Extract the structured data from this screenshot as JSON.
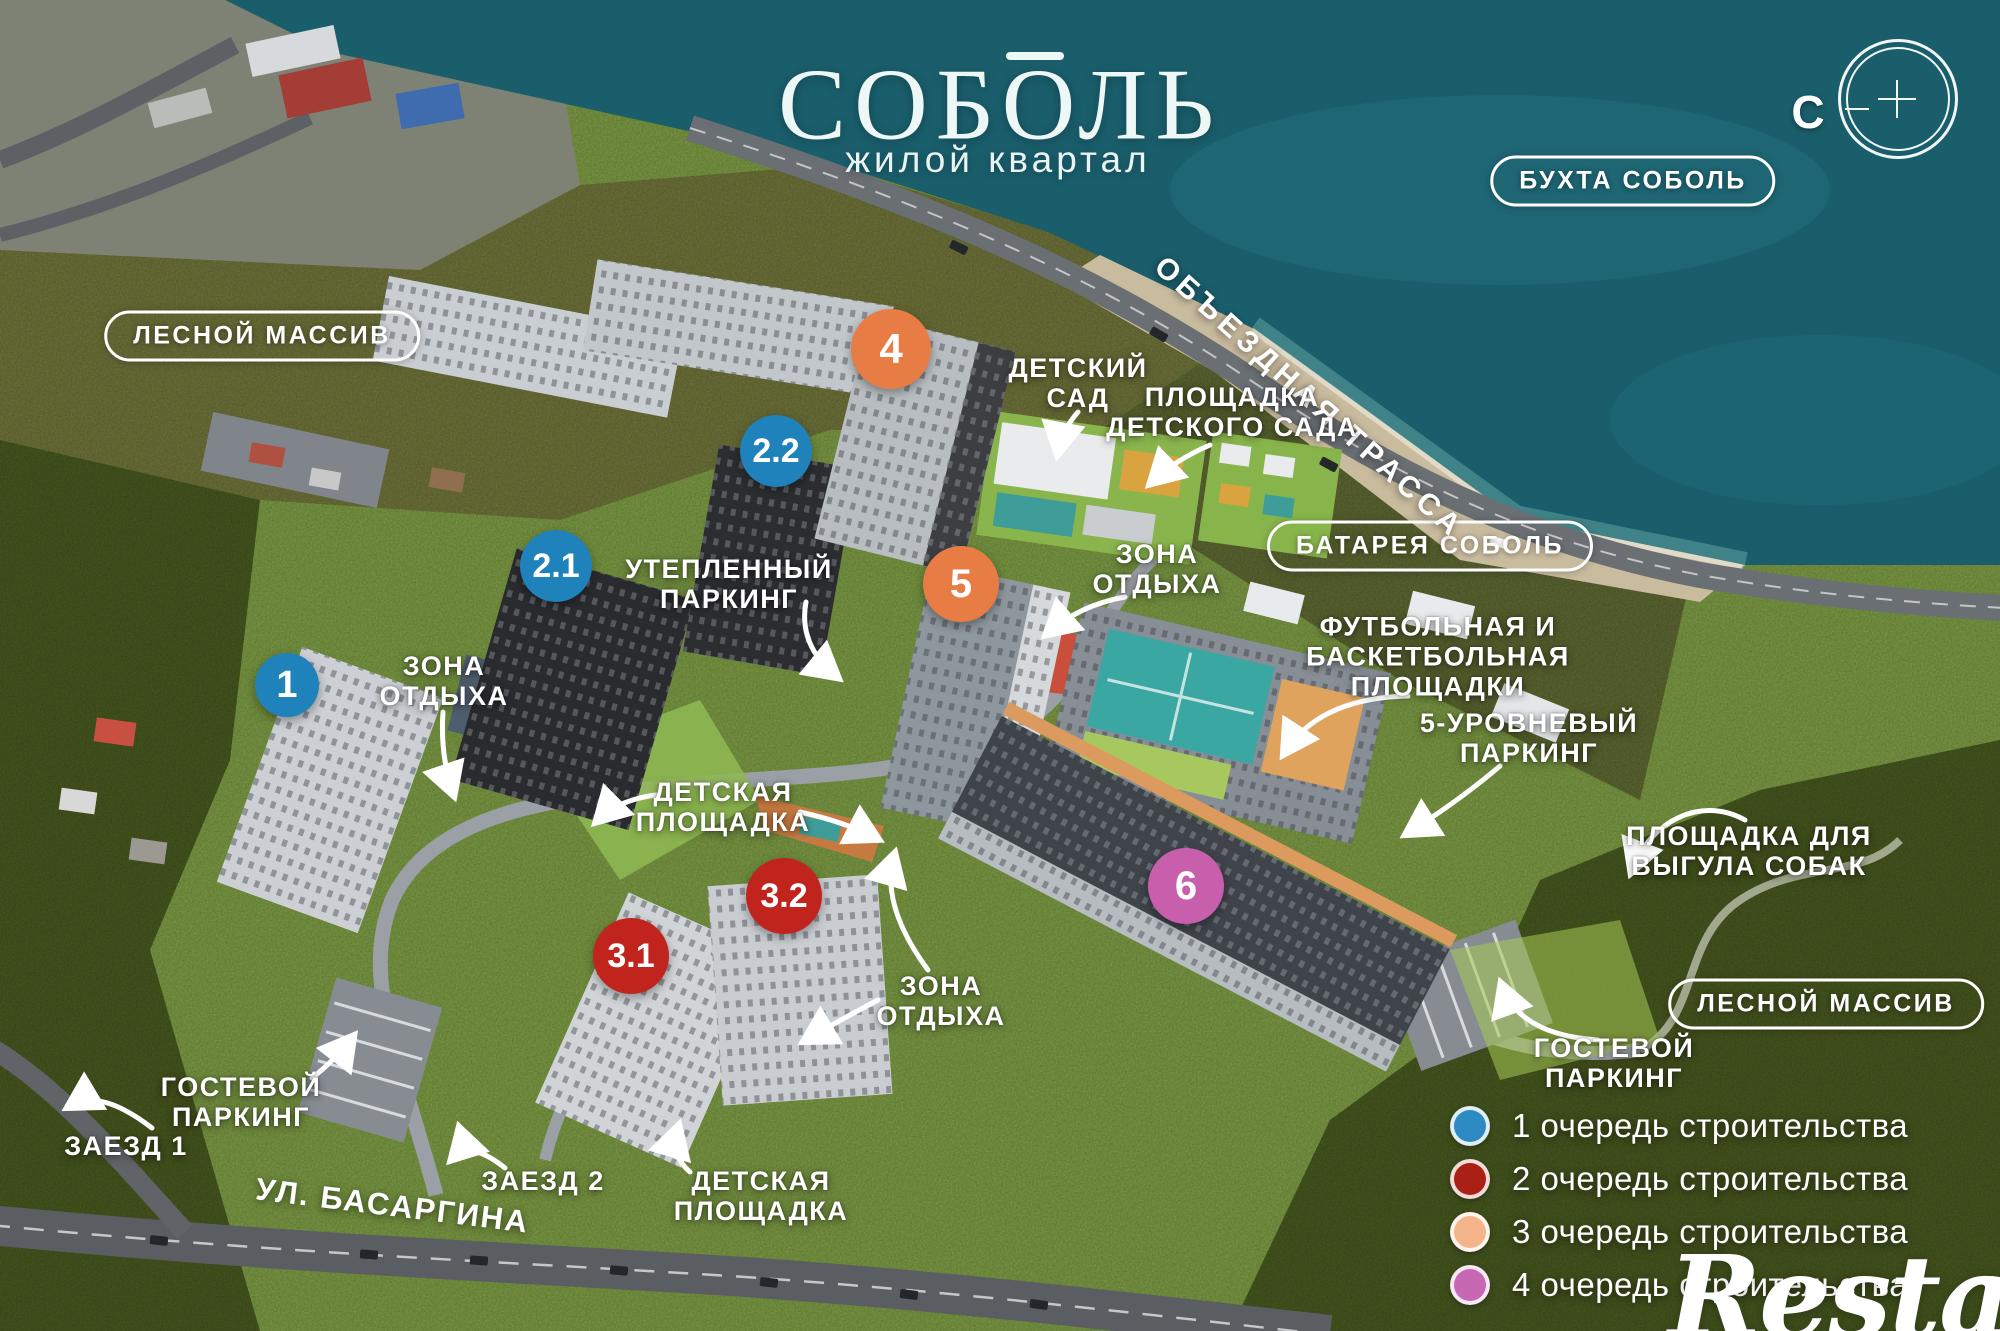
{
  "title": {
    "name": "СОБОЛЬ",
    "subtitle": "жилой квартал"
  },
  "compass": {
    "north_label": "С"
  },
  "area_badges": [
    {
      "id": "lesnoy-massiv-top",
      "label": "ЛЕСНОЙ МАССИВ"
    },
    {
      "id": "buhta-sobol",
      "label": "БУХТА СОБОЛЬ"
    },
    {
      "id": "batareya-sobol",
      "label": "БАТАРЕЯ СОБОЛЬ"
    },
    {
      "id": "lesnoy-massiv-bottom",
      "label": "ЛЕСНОЙ МАССИВ"
    }
  ],
  "road_labels": [
    {
      "id": "obezdnaya-trassa",
      "label": "ОБЪЕЗДНАЯ ТРАССА"
    },
    {
      "id": "ul-basargina",
      "label": "УЛ. БАСАРГИНА"
    }
  ],
  "map_labels": [
    {
      "id": "detskiy-sad",
      "lines": [
        "ДЕТСКИЙ",
        "САД"
      ]
    },
    {
      "id": "ploshchadka-detskogo-sada",
      "lines": [
        "ПЛОЩАДКА",
        "ДЕТСКОГО САДА"
      ]
    },
    {
      "id": "zona-otdyha-top",
      "lines": [
        "ЗОНА",
        "ОТДЫХА"
      ]
    },
    {
      "id": "uteplennyy-parking",
      "lines": [
        "УТЕПЛЕННЫЙ",
        "ПАРКИНГ"
      ]
    },
    {
      "id": "zona-otdyha-left",
      "lines": [
        "ЗОНА",
        "ОТДЫХА"
      ]
    },
    {
      "id": "futbolnaya-basketbolnaya",
      "lines": [
        "ФУТБОЛЬНАЯ И",
        "БАСКЕТБОЛЬНАЯ",
        "ПЛОЩАДКИ"
      ]
    },
    {
      "id": "parking-5-level",
      "lines": [
        "5-УРОВНЕВЫЙ",
        "ПАРКИНГ"
      ]
    },
    {
      "id": "detskaya-ploshchadka-mid",
      "lines": [
        "ДЕТСКАЯ",
        "ПЛОЩАДКА"
      ]
    },
    {
      "id": "ploshchadka-vygula-sobak",
      "lines": [
        "ПЛОЩАДКА ДЛЯ",
        "ВЫГУЛА СОБАК"
      ]
    },
    {
      "id": "zona-otdyha-bottom",
      "lines": [
        "ЗОНА",
        "ОТДЫХА"
      ]
    },
    {
      "id": "gostevoy-parking-left",
      "lines": [
        "ГОСТЕВОЙ",
        "ПАРКИНГ"
      ]
    },
    {
      "id": "zaezd-1",
      "lines": [
        "ЗАЕЗД 1"
      ]
    },
    {
      "id": "zaezd-2",
      "lines": [
        "ЗАЕЗД 2"
      ]
    },
    {
      "id": "detskaya-ploshchadka-bottom",
      "lines": [
        "ДЕТСКАЯ",
        "ПЛОЩАДКА"
      ]
    },
    {
      "id": "gostevoy-parking-right",
      "lines": [
        "ГОСТЕВОЙ",
        "ПАРКИНГ"
      ]
    }
  ],
  "building_markers": [
    {
      "label": "1",
      "color": "#1f82ba"
    },
    {
      "label": "2.1",
      "color": "#1f82ba"
    },
    {
      "label": "2.2",
      "color": "#1f82ba"
    },
    {
      "label": "3.1",
      "color": "#c1241d"
    },
    {
      "label": "3.2",
      "color": "#c1241d"
    },
    {
      "label": "4",
      "color": "#e87c45"
    },
    {
      "label": "5",
      "color": "#e87c45"
    },
    {
      "label": "6",
      "color": "#c75fad"
    }
  ],
  "legend": {
    "items": [
      {
        "color": "#2e8ac2",
        "label": "1 очередь строительства"
      },
      {
        "color": "#ab2015",
        "label": "2 очередь строительства"
      },
      {
        "color": "#f5b48c",
        "label": "3 очередь строительства"
      },
      {
        "color": "#c668b4",
        "label": "4 очередь строительства"
      }
    ]
  },
  "watermark": {
    "text": "Restate"
  }
}
